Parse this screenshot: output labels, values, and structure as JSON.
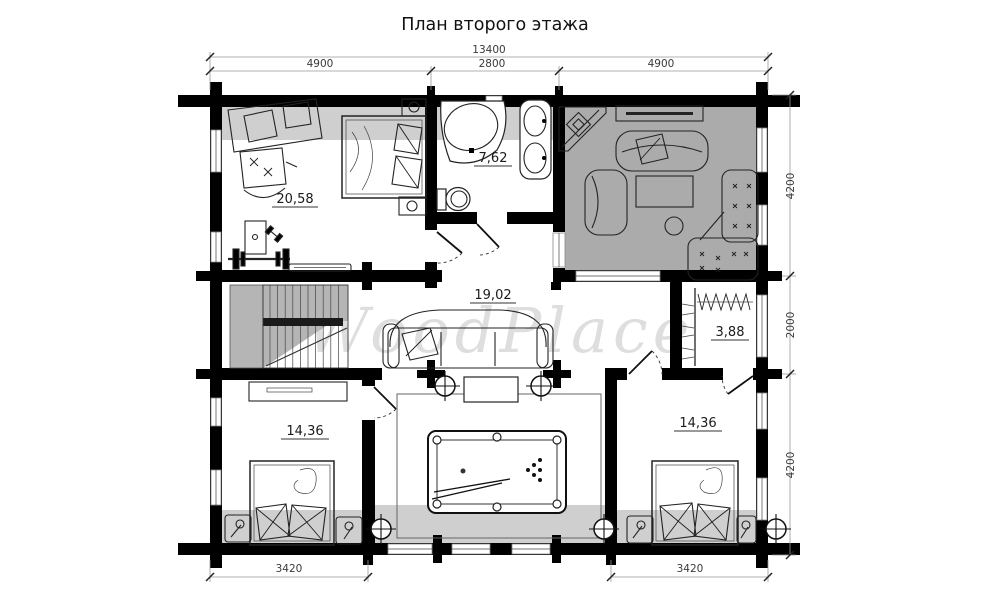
{
  "title": "План второго этажа",
  "watermark": "WoodPlace",
  "rooms": [
    {
      "name": "cabinet",
      "area": "20,58"
    },
    {
      "name": "bathroom",
      "area": "7,62"
    },
    {
      "name": "hall",
      "area": "19,02"
    },
    {
      "name": "closet",
      "area": "3,88"
    },
    {
      "name": "bedroom-left",
      "area": "14,36"
    },
    {
      "name": "bedroom-right",
      "area": "14,36"
    }
  ],
  "dimensions": {
    "top_total": "13400",
    "top_segments": [
      "4900",
      "2800",
      "4900"
    ],
    "right_segments": [
      "4200",
      "2000",
      "4200"
    ],
    "bottom_segments": [
      "3420",
      "3420"
    ]
  },
  "colors": {
    "walls": "#000000",
    "living_room_fill": "#ababab",
    "low_ceiling_strip": "#cfcfcf",
    "stairs_fill": "#b5b5b5",
    "watermark": "#dedede"
  }
}
